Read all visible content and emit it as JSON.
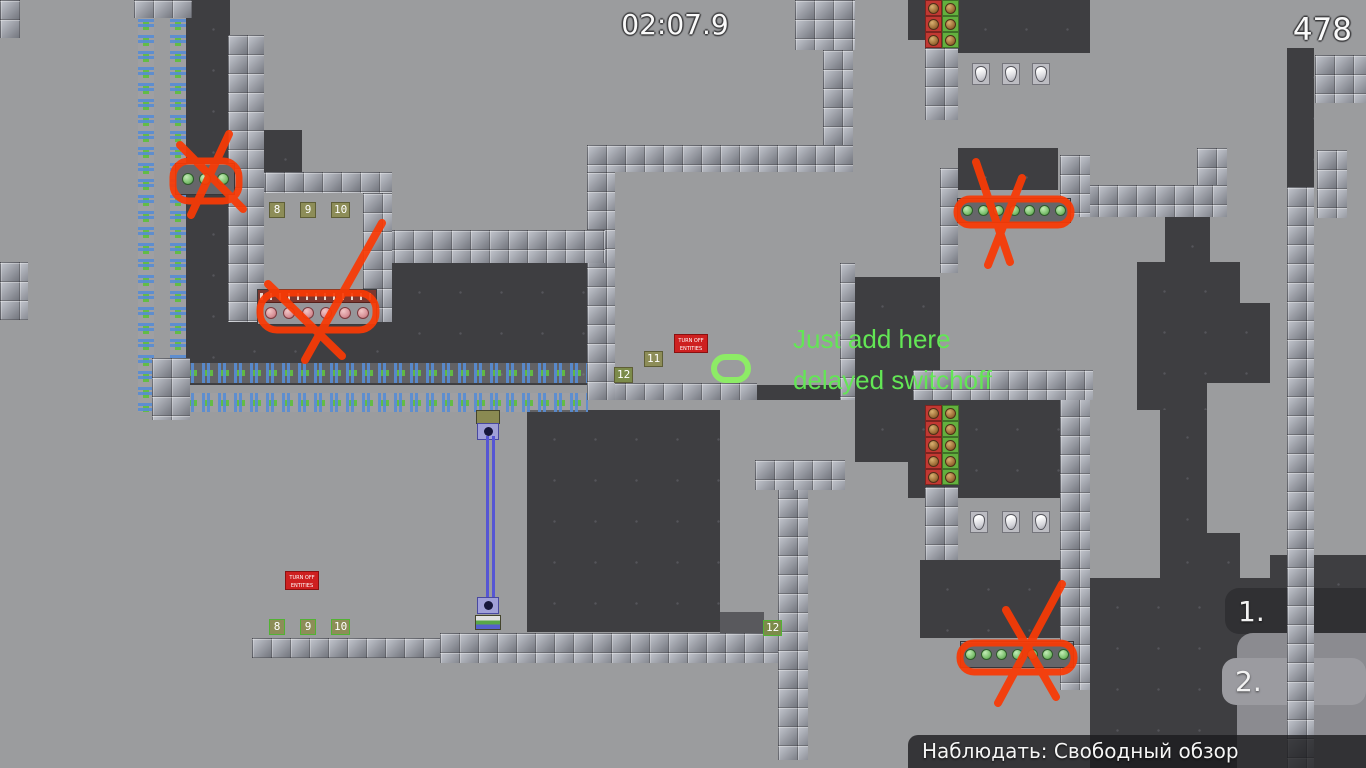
{
  "hud": {
    "timer": "02:07.9",
    "counter": "478",
    "status_text": "Наблюдать: Свободный обзор",
    "marker_1": "1.",
    "marker_2": "2."
  },
  "annotation_notes": {
    "line1": "Just add here",
    "line2": "delayed switchoff"
  },
  "signs": {
    "warning_line1": "TURN OFF",
    "warning_line2": "ENTITIES"
  },
  "switches": {
    "room": [
      "8",
      "9",
      "10"
    ],
    "mid_11": "11",
    "mid_12": "12",
    "bottom": [
      "8",
      "9",
      "10"
    ],
    "bottom_12": "12"
  },
  "colors": {
    "annotation_red": "#f93a05",
    "note_green": "#63e655",
    "oval_green": "#8dec66"
  }
}
